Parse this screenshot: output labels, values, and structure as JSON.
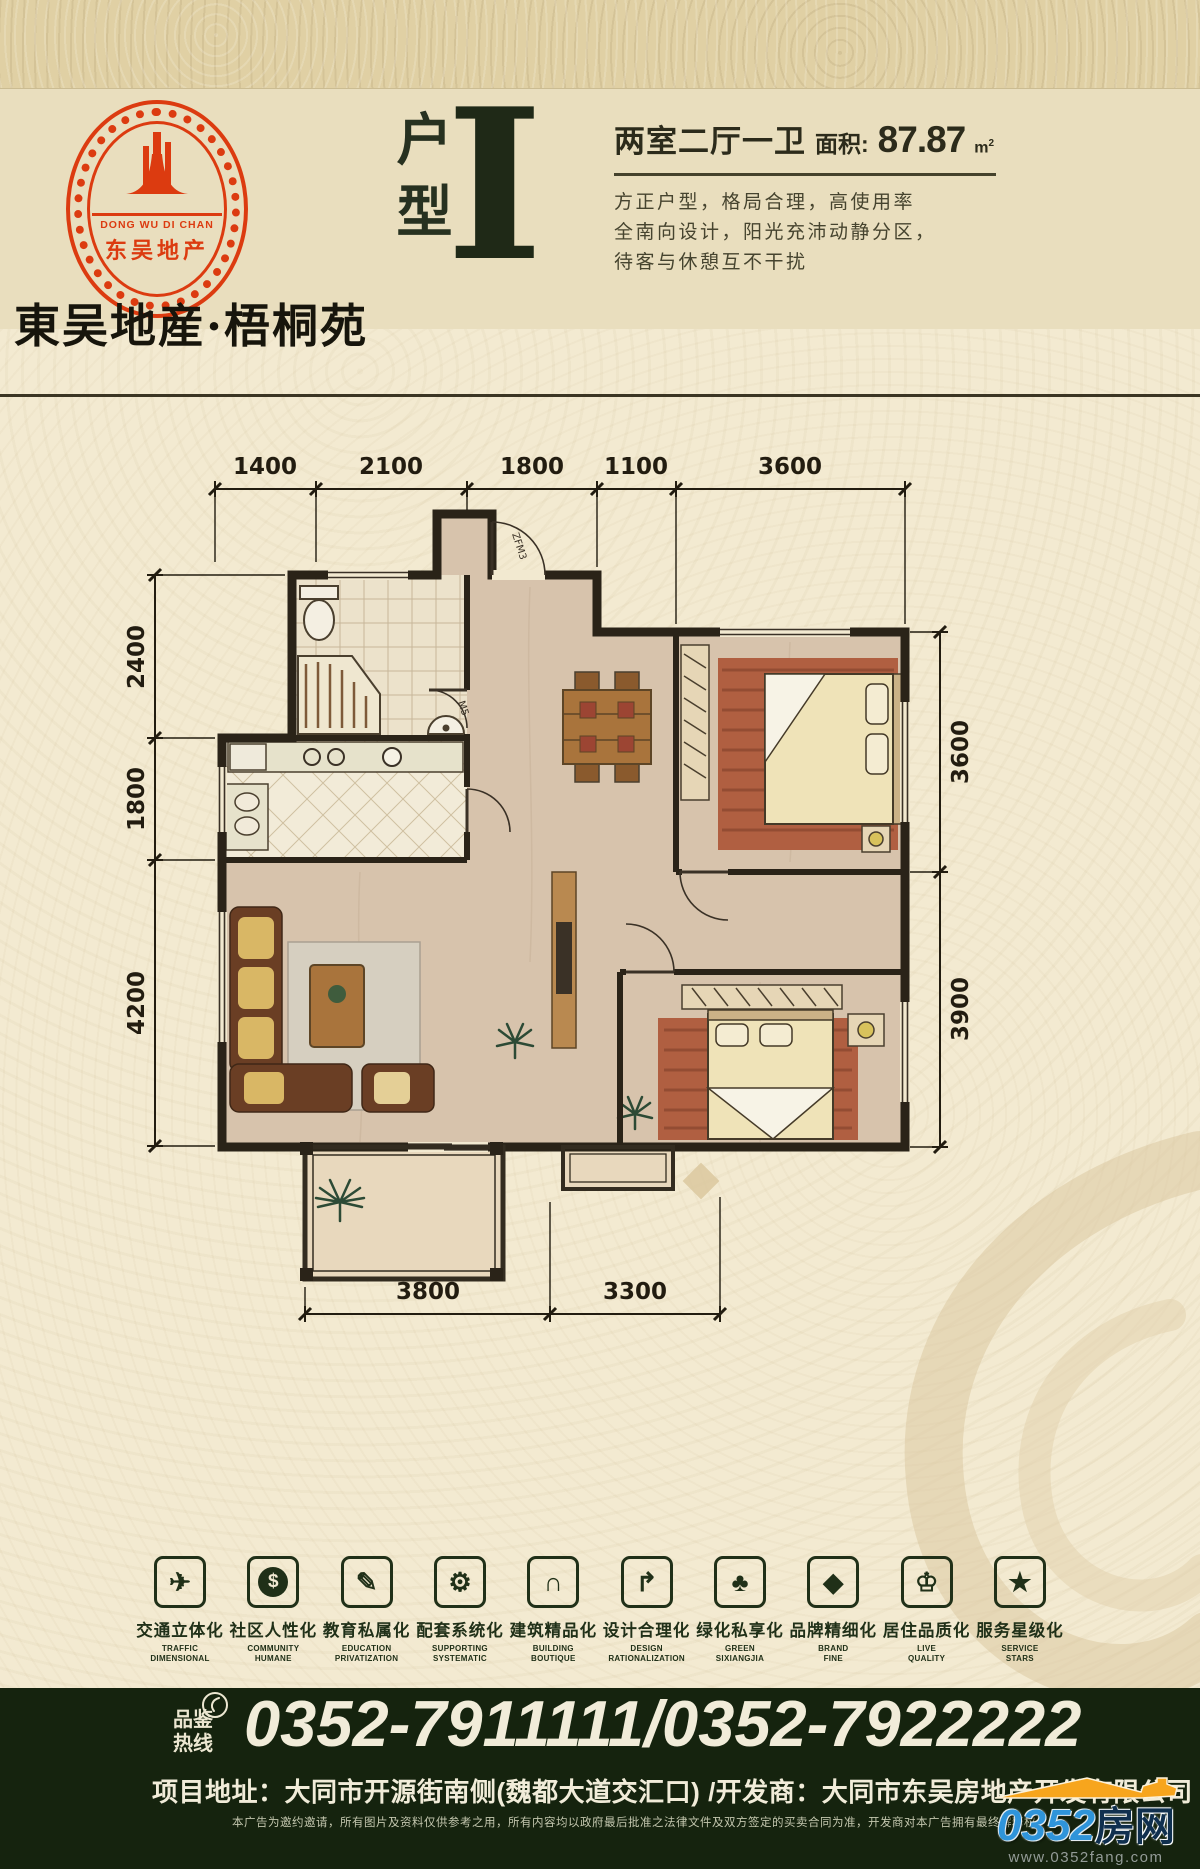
{
  "header": {
    "logo": {
      "ring_text_en": "DONG WU DI CHAN",
      "ring_text_cn": "东吴地产"
    },
    "brand": "東吴地産·梧桐苑",
    "unit_label": "户型",
    "unit_letter": "I",
    "rooms_summary": "两室二厅一卫",
    "area_label": "面积:",
    "area_value": "87.87",
    "area_unit": "m",
    "area_sup": "2",
    "desc_line1": "方正户型，格局合理，高使用率",
    "desc_line2": "全南向设计，阳光充沛动静分区，",
    "desc_line3": "待客与休憩互不干扰"
  },
  "floorplan": {
    "dims_top": [
      "1400",
      "2100",
      "1800",
      "1100",
      "3600"
    ],
    "dims_left": [
      "2400",
      "1800",
      "4200"
    ],
    "dims_right": [
      "3600",
      "3900"
    ],
    "dims_bottom": [
      "3800",
      "3300"
    ],
    "entry_door_label": "ZFM3",
    "bath_door_label": "M5"
  },
  "features": [
    {
      "glyph": "✈",
      "cn": "交通立体化",
      "en1": "TRAFFIC",
      "en2": "DIMENSIONAL"
    },
    {
      "glyph": "$",
      "cn": "社区人性化",
      "en1": "COMMUNITY",
      "en2": "HUMANE"
    },
    {
      "glyph": "✎",
      "cn": "教育私属化",
      "en1": "EDUCATION",
      "en2": "PRIVATIZATION"
    },
    {
      "glyph": "⚙",
      "cn": "配套系统化",
      "en1": "SUPPORTING",
      "en2": "SYSTEMATIC"
    },
    {
      "glyph": "∩",
      "cn": "建筑精品化",
      "en1": "BUILDING",
      "en2": "BOUTIQUE"
    },
    {
      "glyph": "↱",
      "cn": "设计合理化",
      "en1": "DESIGN",
      "en2": "RATIONALIZATION"
    },
    {
      "glyph": "♣",
      "cn": "绿化私享化",
      "en1": "GREEN",
      "en2": "SIXIANGJIA"
    },
    {
      "glyph": "◆",
      "cn": "品牌精细化",
      "en1": "BRAND",
      "en2": "FINE"
    },
    {
      "glyph": "♔",
      "cn": "居住品质化",
      "en1": "LIVE",
      "en2": "QUALITY"
    },
    {
      "glyph": "★",
      "cn": "服务星级化",
      "en1": "SERVICE",
      "en2": "STARS"
    }
  ],
  "footer": {
    "hotline_line1": "品鉴",
    "hotline_line2": "热线",
    "phones": "0352-7911111/0352-7922222",
    "address_label": "项目地址：",
    "address": "大同市开源街南侧(魏都大道交汇口)",
    "developer_label": " /开发商：",
    "developer": "大同市东吴房地产开发有限公司",
    "disclaimer": "本广告为邀约邀请，所有图片及资料仅供参考之用，所有内容均以政府最后批准之法律文件及双方签定的买卖合同为准，开发商对本广告拥有最终解释权。",
    "site_number": "0352",
    "site_suffix": "房网",
    "site_url": "www.0352fang.com"
  },
  "colors": {
    "background": "#f3ead1",
    "header_band": "#e9debe",
    "accent_red": "#dc3b10",
    "dark_green": "#15230e",
    "site_blue": "#2f94da",
    "roof_orange": "#f7a51d"
  }
}
